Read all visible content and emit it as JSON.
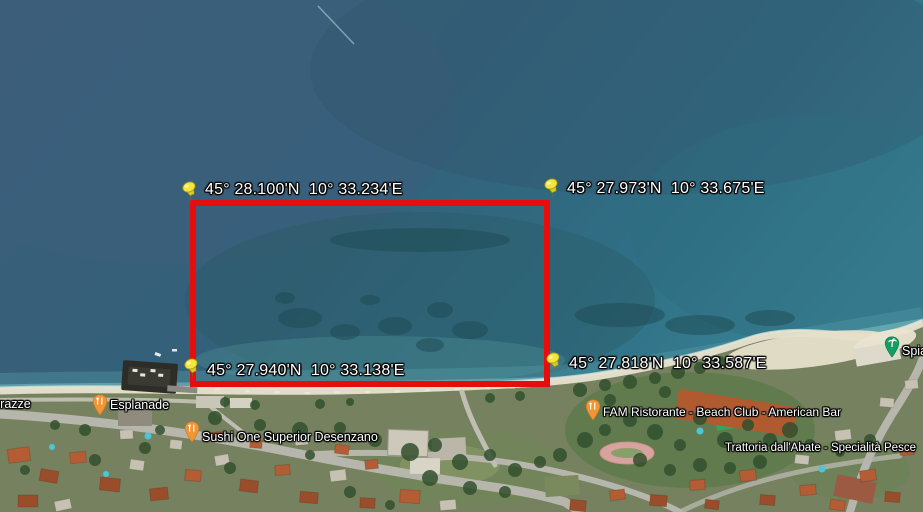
{
  "map": {
    "corner_markers": [
      {
        "position": "top-left",
        "label": "45° 28.100'N  10° 33.234'E"
      },
      {
        "position": "top-right",
        "label": "45° 27.973'N  10° 33.675'E"
      },
      {
        "position": "bottom-left",
        "label": "45° 27.940'N  10° 33.138'E"
      },
      {
        "position": "bottom-right",
        "label": "45° 27.818'N  10° 33.587'E"
      }
    ],
    "places": {
      "esplanade": {
        "label": "Esplanade",
        "type": "restaurant"
      },
      "sushi": {
        "label": "Sushi One Superior Desenzano",
        "type": "restaurant"
      },
      "fam": {
        "label": "FAM Ristorante - Beach Club - American Bar",
        "type": "restaurant"
      },
      "trattoria": {
        "label": "Trattoria dall'Abate - Specialità Pesce",
        "type": "restaurant"
      },
      "terrazze_partial": {
        "label": "rrazze",
        "type": "cut-off-label"
      },
      "spiaggia_partial": {
        "label": "Spia",
        "type": "beach"
      }
    },
    "colors": {
      "selection_rectangle": "#e60d0d",
      "pushpin": "#f3e63a",
      "restaurant_pin": "#f09635",
      "beach_pin": "#149e62",
      "label_text": "#ffffff"
    }
  }
}
